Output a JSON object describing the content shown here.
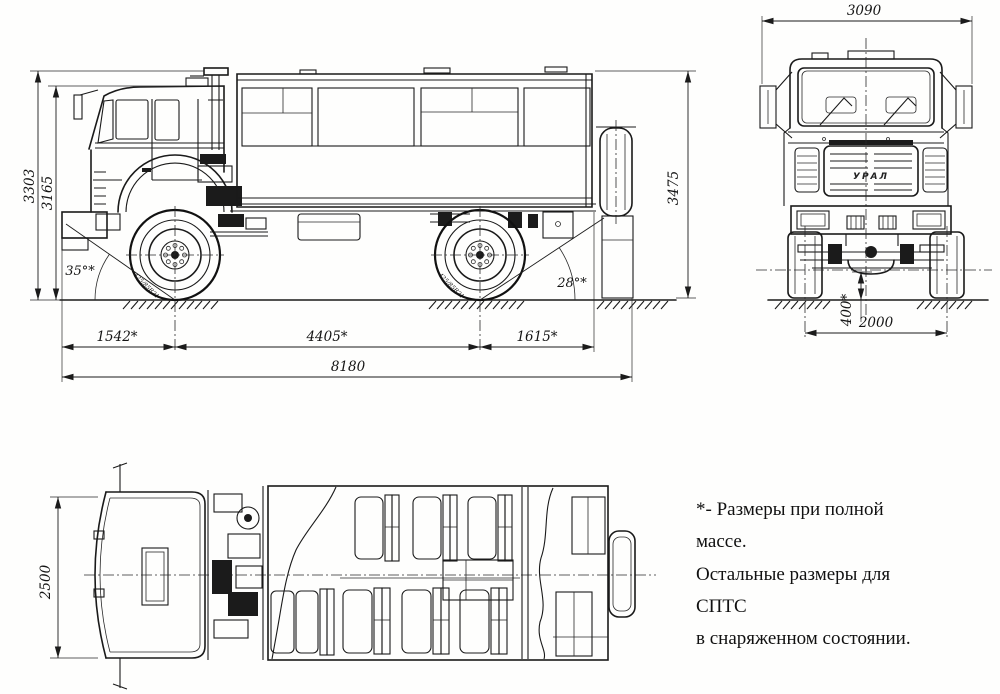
{
  "note": {
    "line1": "*- Размеры при полной массе.",
    "line2": "Остальные размеры для СПТС",
    "line3": "в снаряженном состоянии."
  },
  "dims": {
    "side": {
      "overall_height": "3303",
      "cab_height": "3165",
      "rear_height": "3475",
      "front_overhang": "1542*",
      "wheelbase": "4405*",
      "rear_overhang": "1615*",
      "overall_length": "8180",
      "approach_angle": "35°*",
      "departure_angle": "28°*",
      "tire_marking": "425/85R21"
    },
    "front": {
      "overall_width": "3090",
      "ground_clearance": "400*",
      "track": "2000",
      "grille_label": "УРАЛ"
    },
    "top": {
      "cab_width": "2500"
    }
  }
}
